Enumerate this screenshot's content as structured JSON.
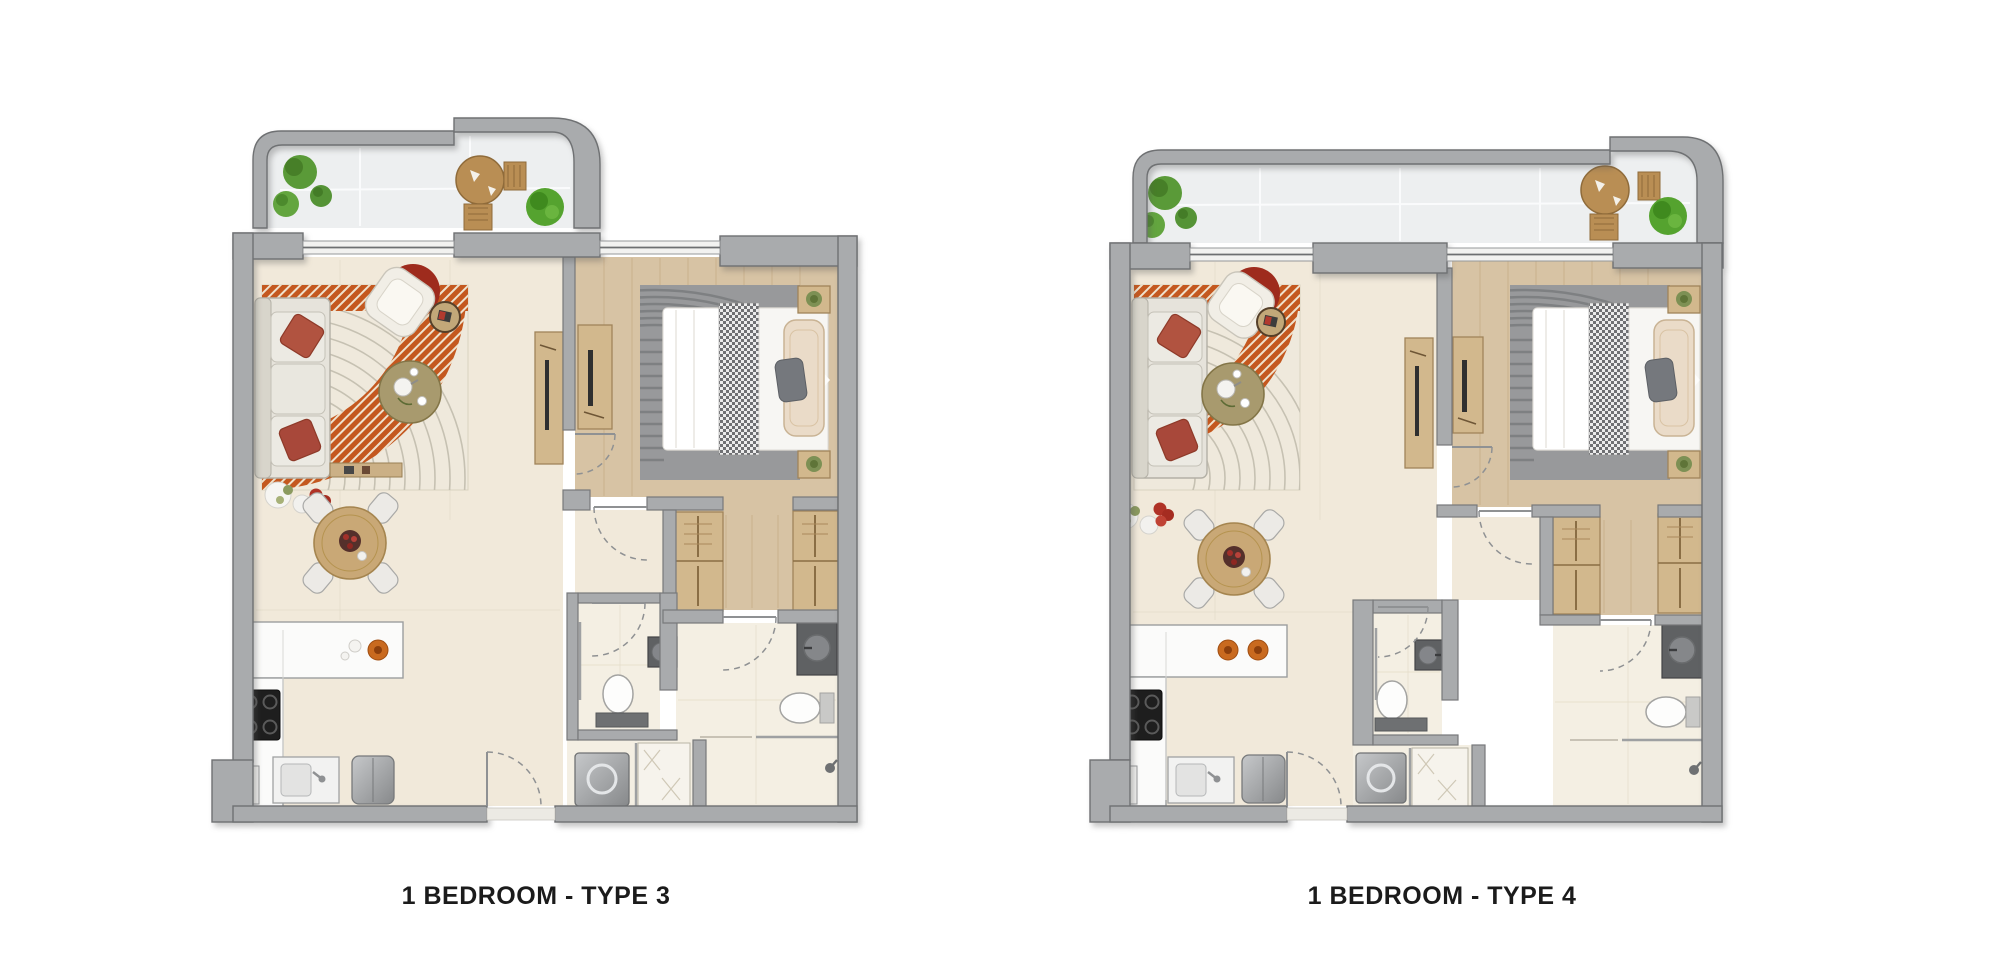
{
  "page": {
    "background": "#ffffff"
  },
  "plans": [
    {
      "id": "type-3",
      "caption": "1 BEDROOM - TYPE 3"
    },
    {
      "id": "type-4",
      "caption": "1 BEDROOM - TYPE 4"
    }
  ],
  "palette": {
    "wall": "#a9abad",
    "wall_edge": "#6f7173",
    "floor_cream": "#f1e9da",
    "floor_wood": "#d7c3a4",
    "floor_tile": "#f4efe3",
    "balcony_floor": "#edeff0",
    "rug_orange": "#c4581f",
    "accent_red": "#ad4a3c",
    "plant_green": "#5a9a38",
    "counter_white": "#fbfbfa",
    "appliance_gray": "#9fa1a3",
    "dark_fixture": "#5f6163"
  }
}
